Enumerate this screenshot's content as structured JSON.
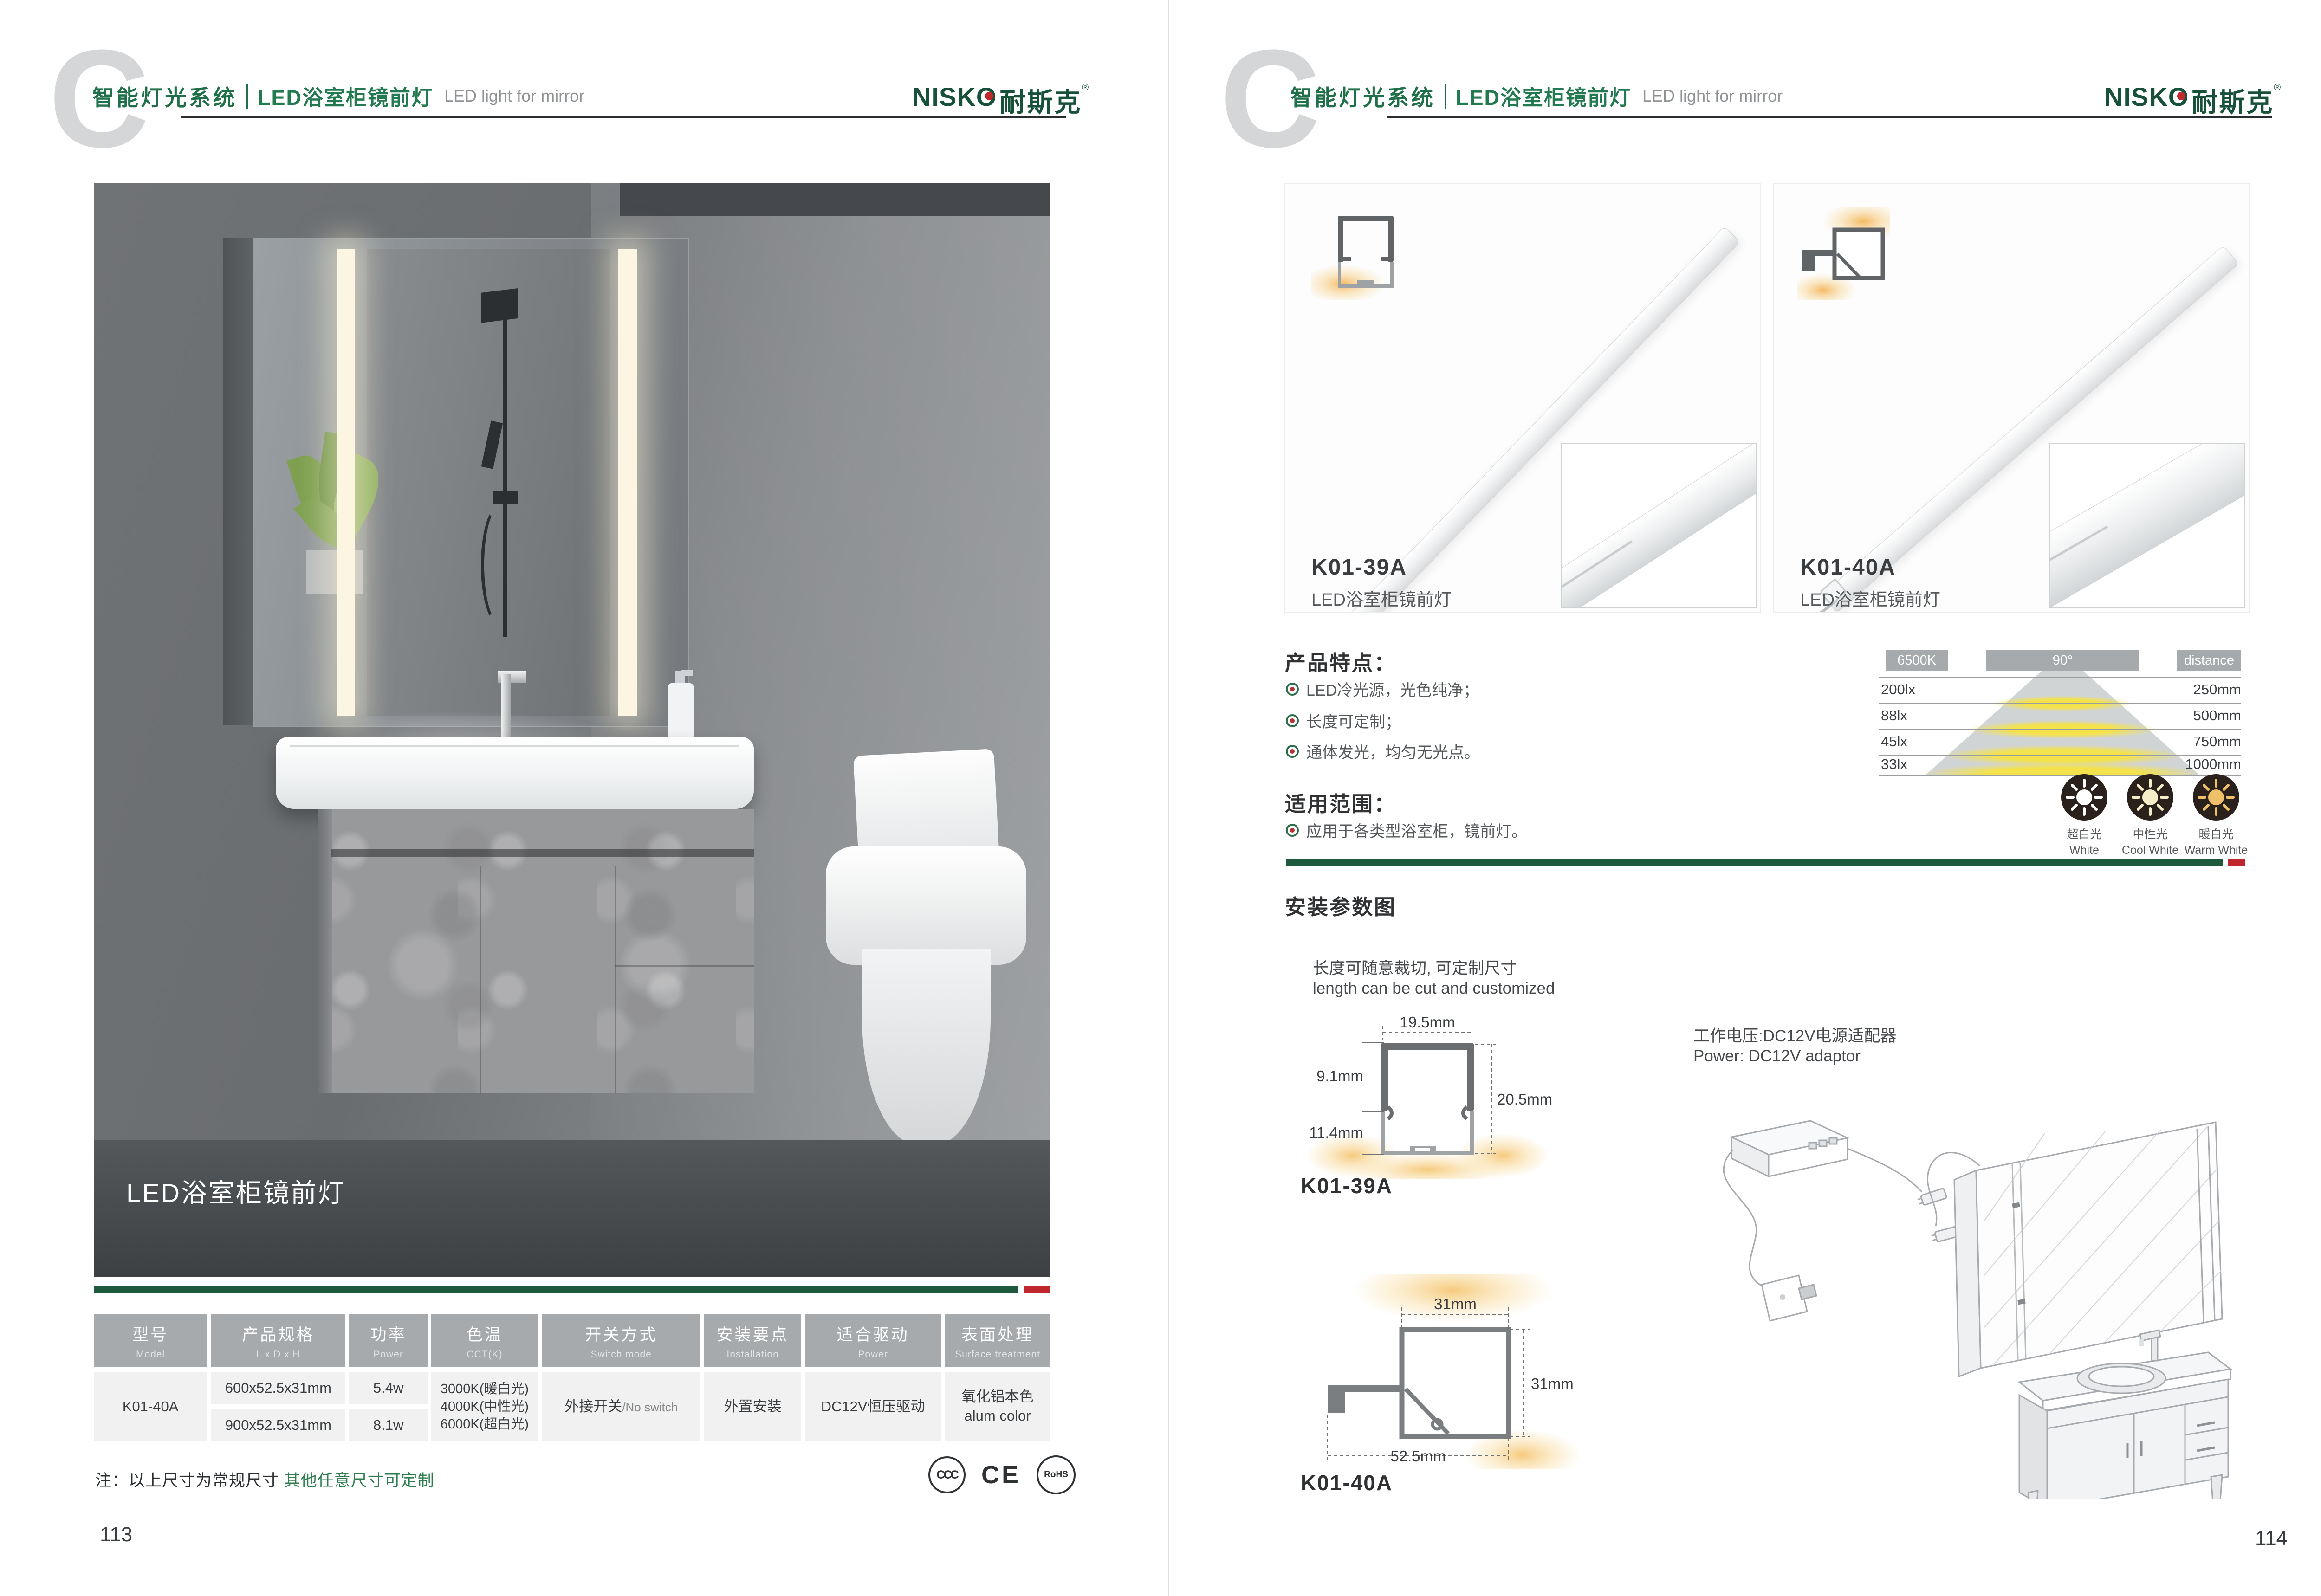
{
  "brand": {
    "watermark": "C",
    "logo_en": "NISKO",
    "logo_cn": "耐斯克",
    "reg": "®",
    "accent_green": "#1D5A3E",
    "accent_red": "#C0272C"
  },
  "header": {
    "system_cn": "智能灯光系统",
    "product_cn": "LED浴室柜镜前灯",
    "product_en": "LED light for mirror"
  },
  "left_page": {
    "photo_caption": "LED浴室柜镜前灯",
    "table": {
      "headers": [
        {
          "cn": "型号",
          "en": "Model"
        },
        {
          "cn": "产品规格",
          "en": "L x D x H"
        },
        {
          "cn": "功率",
          "en": "Power"
        },
        {
          "cn": "色温",
          "en": "CCT(K)"
        },
        {
          "cn": "开关方式",
          "en": "Switch mode"
        },
        {
          "cn": "安装要点",
          "en": "Installation"
        },
        {
          "cn": "适合驱动",
          "en": "Power"
        },
        {
          "cn": "表面处理",
          "en": "Surface treatment"
        }
      ],
      "row": {
        "model": "K01-40A",
        "specs": [
          "600x52.5x31mm",
          "900x52.5x31mm"
        ],
        "powers": [
          "5.4w",
          "8.1w"
        ],
        "cct": [
          "3000K(暖白光)",
          "4000K(中性光)",
          "6000K(超白光)"
        ],
        "switch_cn": "外接开关",
        "switch_en": "/No switch",
        "installation": "外置安装",
        "driver": "DC12V恒压驱动",
        "surface_cn": "氧化铝本色",
        "surface_en": "alum color"
      }
    },
    "note_prefix": "注：以上尺寸为常规尺寸 ",
    "note_highlight": "其他任意尺寸可定制",
    "certs": [
      "CCC",
      "CE",
      "RoHS"
    ],
    "page_number": "113"
  },
  "right_page": {
    "cards": [
      {
        "model": "K01-39A",
        "name": "LED浴室柜镜前灯"
      },
      {
        "model": "K01-40A",
        "name": "LED浴室柜镜前灯"
      }
    ],
    "features": {
      "title": "产品特点：",
      "items": [
        "LED冷光源，光色纯净；",
        "长度可定制；",
        "通体发光，均匀无光点。"
      ]
    },
    "distribution": {
      "cct": "6500K",
      "angle": "90°",
      "distance_label": "distance",
      "rows": [
        {
          "lux": "200lx",
          "distance": "250mm"
        },
        {
          "lux": "88lx",
          "distance": "500mm"
        },
        {
          "lux": "45lx",
          "distance": "750mm"
        },
        {
          "lux": "33lx",
          "distance": "1000mm"
        }
      ]
    },
    "application": {
      "title": "适用范围：",
      "items": [
        "应用于各类型浴室柜，镜前灯。"
      ]
    },
    "cct_icons": [
      {
        "cn": "超白光",
        "en": "White",
        "color": "#FFFFFF"
      },
      {
        "cn": "中性光",
        "en": "Cool White",
        "color": "#F5ECC8"
      },
      {
        "cn": "暖白光",
        "en": "Warm White",
        "color": "#EEC06A"
      }
    ],
    "install": {
      "title": "安装参数图",
      "cut_cn": "长度可随意裁切, 可定制尺寸",
      "cut_en": "length can be cut and customized",
      "power_cn": "工作电压:DC12V电源适配器",
      "power_en": "Power: DC12V adaptor",
      "diagram_39a": {
        "model": "K01-39A",
        "width_top": "19.5mm",
        "height_upper": "9.1mm",
        "height_lower": "11.4mm",
        "height_total": "20.5mm"
      },
      "diagram_40a": {
        "model": "K01-40A",
        "width_top": "31mm",
        "height_right": "31mm",
        "width_bottom": "52.5mm"
      }
    },
    "page_number": "114"
  }
}
